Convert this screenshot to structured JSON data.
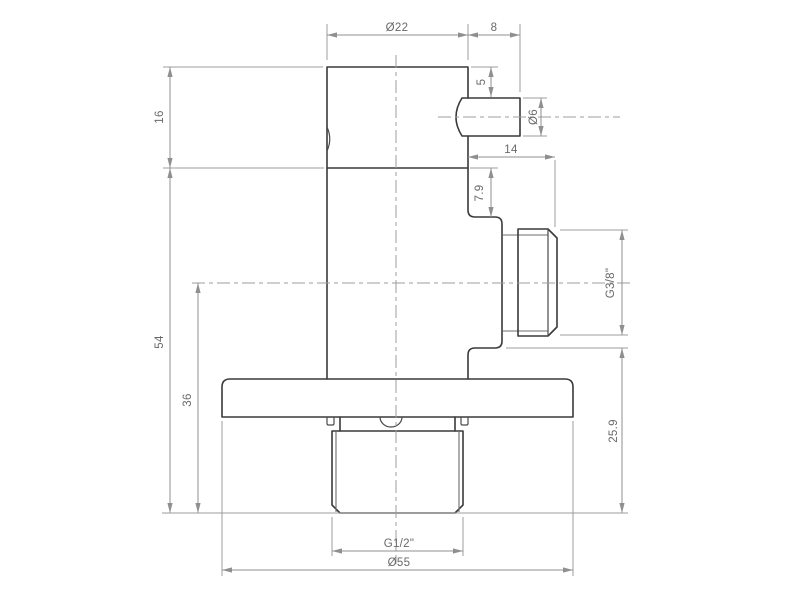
{
  "drawing": {
    "dimensions": {
      "body_diameter": "Ø22",
      "spout_length": "8",
      "spout_top_offset": "5",
      "spout_diameter": "Ø6",
      "side_outlet_length": "14",
      "side_outlet_top_offset": "7.9",
      "side_outlet_thread": "G3/8\"",
      "side_outlet_bottom_height": "25.9",
      "head_height": "16",
      "body_height": "54",
      "outlet_axis_height": "36",
      "inlet_thread": "G1/2\"",
      "flange_diameter": "Ø55"
    },
    "colors": {
      "background": "#ffffff",
      "outline": "#3a3a3a",
      "dimension_lines": "#8f8f8f",
      "dimension_text": "#696969"
    }
  }
}
